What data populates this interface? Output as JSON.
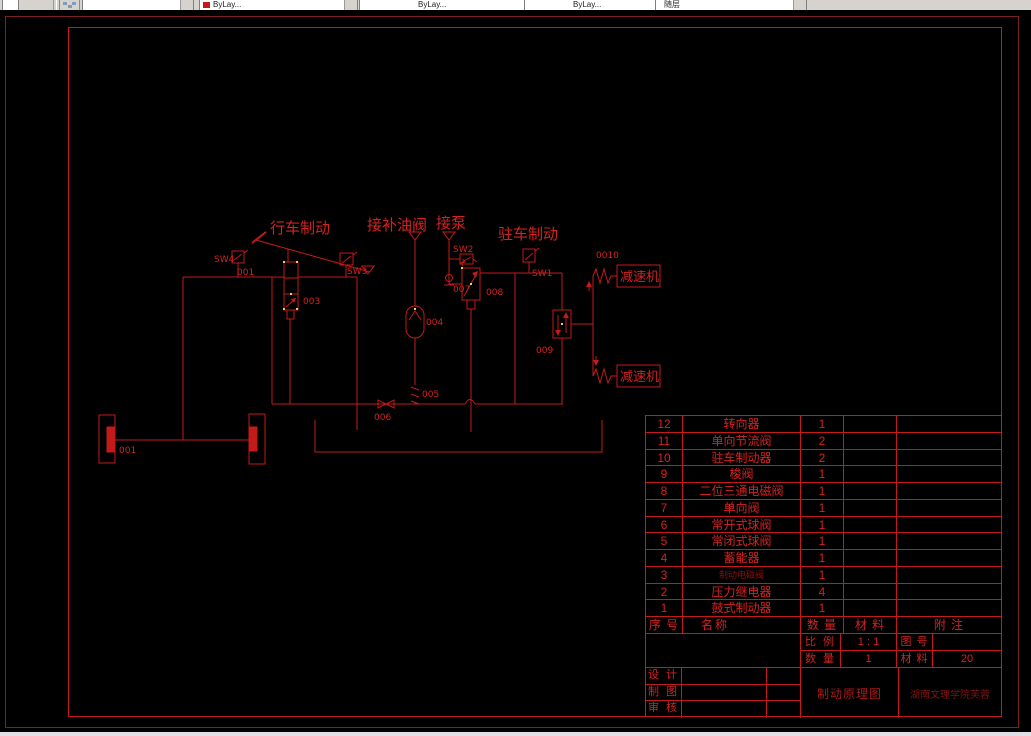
{
  "toolbar": {
    "color_value": "ByLay...",
    "linetype_value": "ByLay...",
    "lineweight_value": "ByLay...",
    "plotstyle_value": "随层"
  },
  "schematic": {
    "labels": {
      "service_brake": "行车制动",
      "supply_valve": "接补油阀",
      "to_pump": "接泵",
      "parking_brake": "驻车制动",
      "reducer_top": "减速机",
      "reducer_bottom": "减速机"
    },
    "tags": {
      "sw1": "SW1",
      "sw2": "SW2",
      "sw3": "SW3",
      "sw4": "SW4",
      "c001a": "001",
      "c001b": "001",
      "c003": "003",
      "c004": "004",
      "c005": "005",
      "c006": "006",
      "c007": "007",
      "c008": "008",
      "c009": "009",
      "c0010": "0010"
    }
  },
  "parts_table": {
    "header": {
      "no": "序 号",
      "name": "名称",
      "qty": "数 量",
      "material": "材 料",
      "note": "附 注"
    },
    "rows": [
      {
        "no": "12",
        "name": "转向器",
        "qty": "1",
        "dim": false
      },
      {
        "no": "11",
        "name": "单向节流阀",
        "qty": "2",
        "dim": false
      },
      {
        "no": "10",
        "name": "驻车制动器",
        "qty": "2",
        "dim": false
      },
      {
        "no": "9",
        "name": "梭阀",
        "qty": "1",
        "dim": false
      },
      {
        "no": "8",
        "name": "二位三通电磁阀",
        "qty": "1",
        "dim": false
      },
      {
        "no": "7",
        "name": "单向阀",
        "qty": "1",
        "dim": false
      },
      {
        "no": "6",
        "name": "常开式球阀",
        "qty": "1",
        "dim": false
      },
      {
        "no": "5",
        "name": "常闭式球阀",
        "qty": "1",
        "dim": false
      },
      {
        "no": "4",
        "name": "蓄能器",
        "qty": "1",
        "dim": false
      },
      {
        "no": "3",
        "name": "制动电磁阀",
        "qty": "1",
        "dim": true
      },
      {
        "no": "2",
        "name": "压力继电器",
        "qty": "4",
        "dim": false
      },
      {
        "no": "1",
        "name": "鼓式制动器",
        "qty": "1",
        "dim": false
      }
    ]
  },
  "title_block": {
    "scale_label": "比 例",
    "scale_value": "1 : 1",
    "dwgno_label": "图 号",
    "dwgno_value": "",
    "qty_label": "数 量",
    "qty_value": "1",
    "material_label": "材 料",
    "material_value": "20",
    "design_label": "设 计",
    "draft_label": "制 图",
    "check_label": "审 核",
    "drawing_title": "制动原理图",
    "organization": "湖南文理学院芙蓉"
  }
}
